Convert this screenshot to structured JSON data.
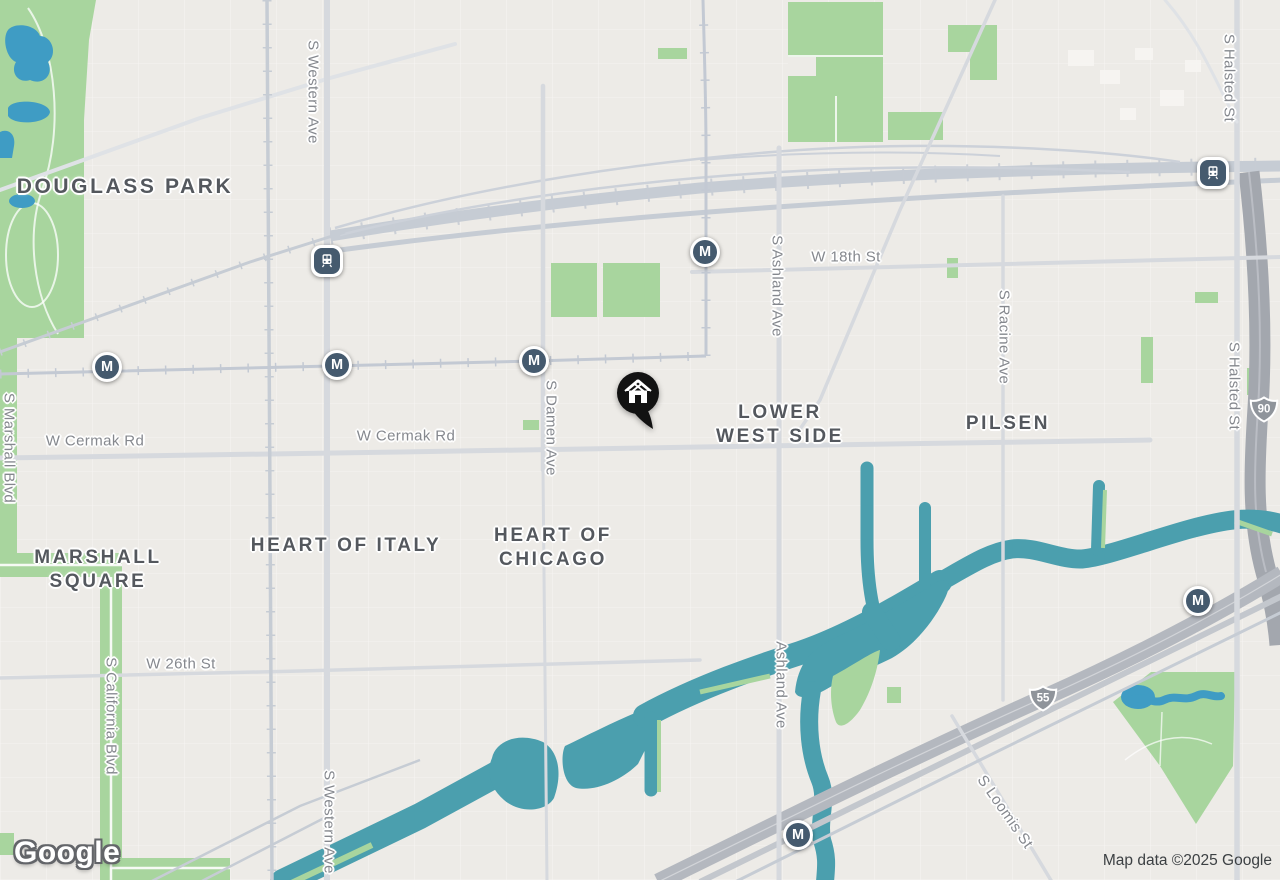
{
  "branding": {
    "logo_text": "Google",
    "attribution": "Map data ©2025 Google"
  },
  "neighborhoods": [
    {
      "id": "douglass-park",
      "line1": "DOUGLASS PARK",
      "line2": ""
    },
    {
      "id": "marshall-square",
      "line1": "MARSHALL",
      "line2": "SQUARE"
    },
    {
      "id": "heart-of-italy",
      "line1": "HEART OF ITALY",
      "line2": ""
    },
    {
      "id": "heart-of-chicago",
      "line1": "HEART OF",
      "line2": "CHICAGO"
    },
    {
      "id": "lower-west-side",
      "line1": "LOWER",
      "line2": "WEST SIDE"
    },
    {
      "id": "pilsen",
      "line1": "PILSEN",
      "line2": ""
    }
  ],
  "streets": [
    {
      "id": "s-western-ave-top",
      "text": "S Western Ave"
    },
    {
      "id": "s-western-ave-bottom",
      "text": "S Western Ave"
    },
    {
      "id": "s-marshall-blvd",
      "text": "S Marshall Blvd"
    },
    {
      "id": "s-california-blvd",
      "text": "S California Blvd"
    },
    {
      "id": "w-cermak-rd-left",
      "text": "W Cermak Rd"
    },
    {
      "id": "w-cermak-rd-center",
      "text": "W Cermak Rd"
    },
    {
      "id": "s-damen-ave",
      "text": "S Damen Ave"
    },
    {
      "id": "w-18th-st",
      "text": "W 18th St"
    },
    {
      "id": "s-ashland-ave",
      "text": "S Ashland Ave"
    },
    {
      "id": "ashland-ave",
      "text": "Ashland Ave"
    },
    {
      "id": "s-racine-ave",
      "text": "S Racine Ave"
    },
    {
      "id": "s-halsted-st-top",
      "text": "S Halsted St"
    },
    {
      "id": "s-halsted-st-bottom",
      "text": "S Halsted St"
    },
    {
      "id": "w-26th-st",
      "text": "W 26th St"
    },
    {
      "id": "s-loomis-st",
      "text": "S Loomis St"
    }
  ],
  "route_shields": [
    {
      "id": "interstate-55",
      "number": "55"
    },
    {
      "id": "interstate-90",
      "number": "90"
    }
  ],
  "icons": {
    "metro_badge": "M",
    "train_badge": "train-front",
    "home_pin": "house-in-black-pin"
  },
  "colors": {
    "background": "#edebe7",
    "water_river": "#4b9fae",
    "water_pond": "#3f9cc4",
    "park_green": "#a8d59e",
    "road": "#d6d9de",
    "rail": "#c6ccd4",
    "expressway": "#a3a7ae",
    "highway_55": "#b4b8bf",
    "marker_background": "#455a6e",
    "neighborhood_text": "#54585e",
    "street_text": "#85888e"
  }
}
